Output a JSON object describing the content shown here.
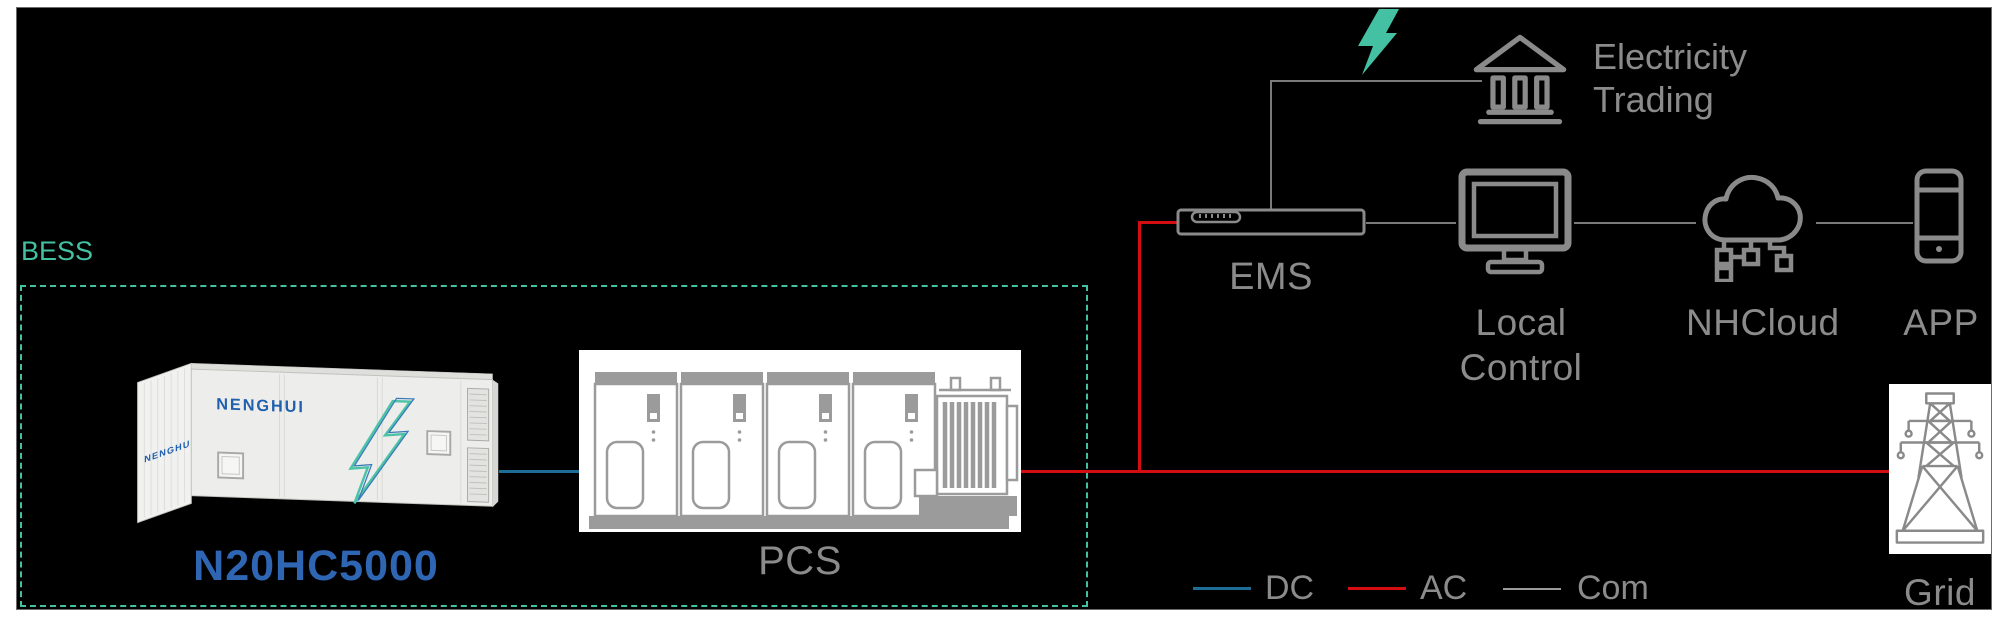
{
  "colors": {
    "canvas-bg": "#000000",
    "page-bg": "#ffffff",
    "teal": "#43c1a2",
    "dc": "#1d6d96",
    "ac": "#d30d12",
    "com": "#7a7a7a",
    "icon-gray": "#8a8a8a",
    "label-gray": "#8b8b8b",
    "brand-blue": "#2e66b4",
    "logo-blue": "#2060ae"
  },
  "bess": {
    "label": "BESS",
    "model": "N20HC5000",
    "brand": "NENGHUI",
    "brand_side": "NENGHUI"
  },
  "pcs": {
    "label": "PCS"
  },
  "ems": {
    "label": "EMS"
  },
  "nodes": {
    "electricity_trading": {
      "line1": "Electricity",
      "line2": "Trading"
    },
    "local_control": {
      "line1": "Local",
      "line2": "Control"
    },
    "nhcloud": {
      "label": "NHCloud"
    },
    "app": {
      "label": "APP"
    },
    "grid": {
      "label": "Grid"
    }
  },
  "legend": {
    "items": [
      {
        "label": "DC",
        "color": "#1d6d96"
      },
      {
        "label": "AC",
        "color": "#d30d12"
      },
      {
        "label": "Com",
        "color": "#9a9a9a"
      }
    ]
  }
}
